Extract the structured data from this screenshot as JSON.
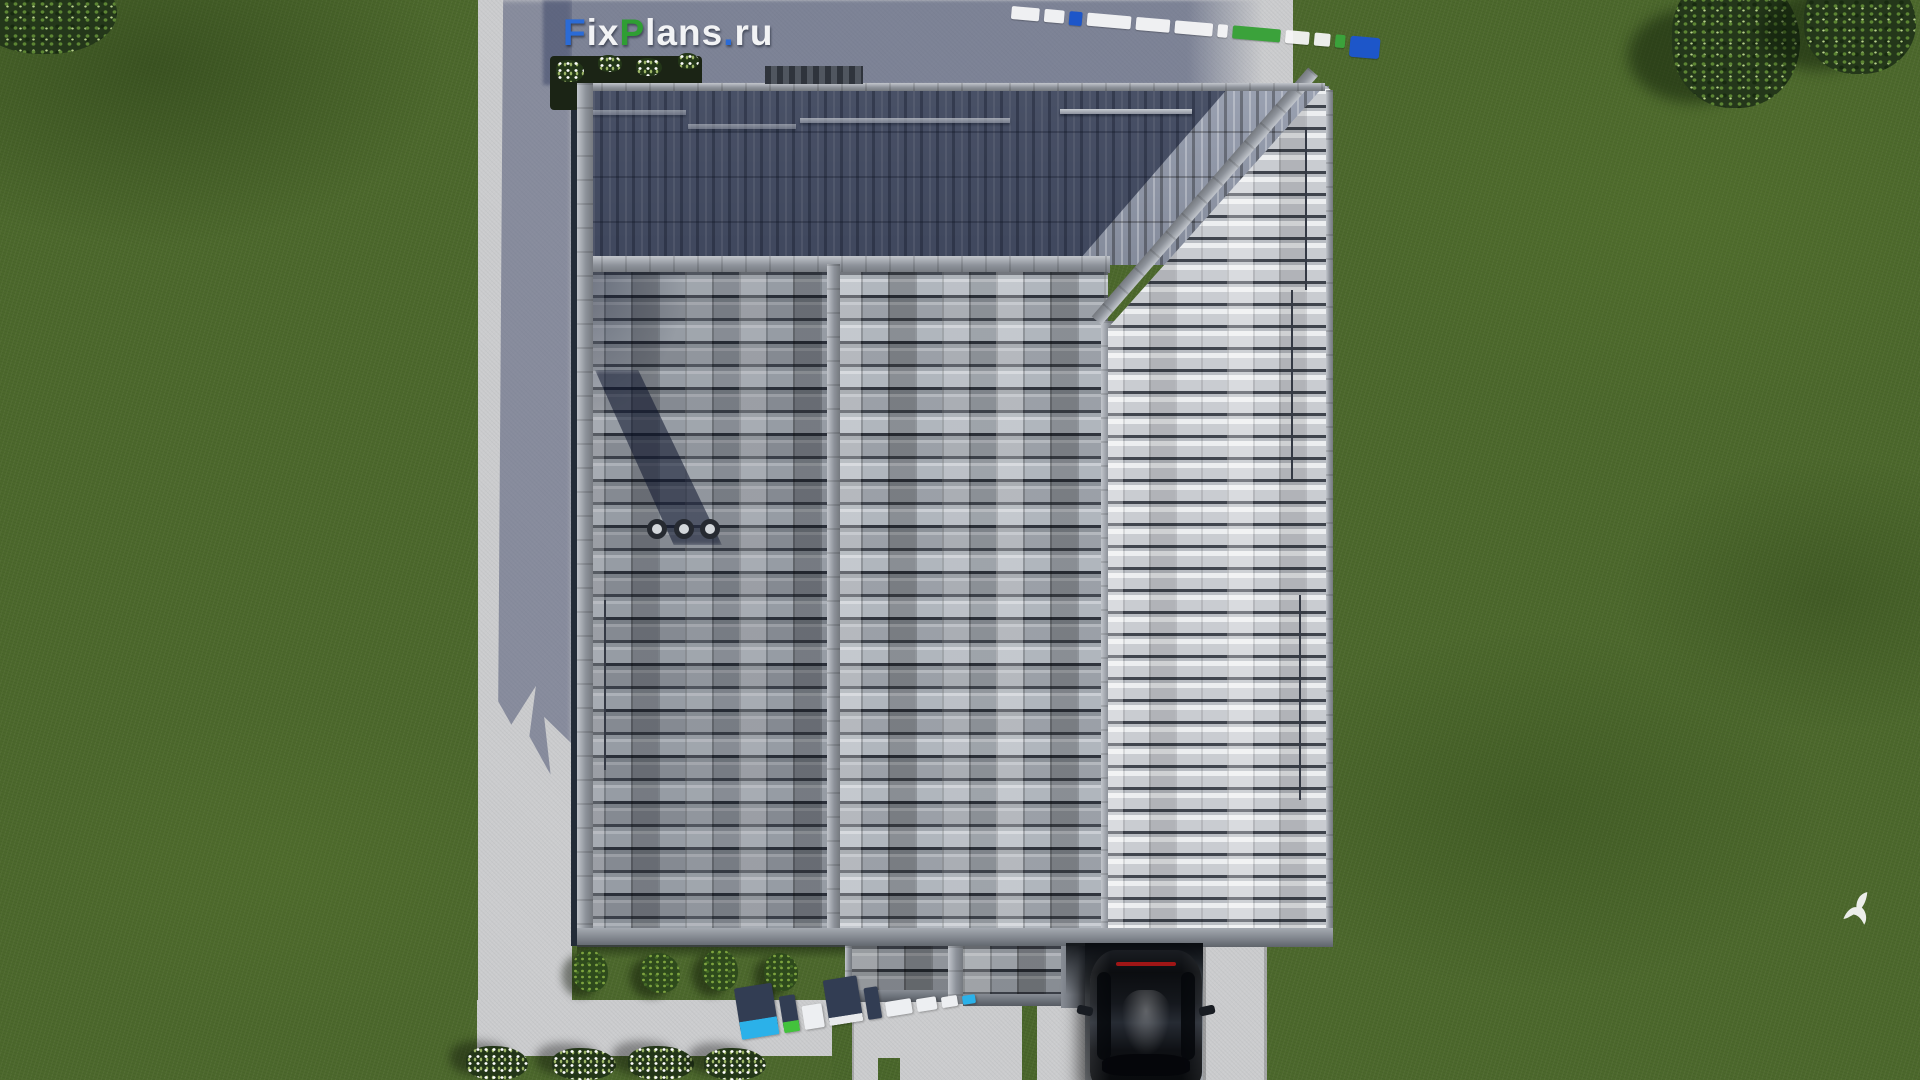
{
  "meta": {
    "description": "Aerial top-down 3D architectural render of a hip-roofed house with concrete tile roof, surrounding lawn, paved paths, driveway with black car, and FixPlans.ru watermarks",
    "scene_width": 1920,
    "scene_height": 1080
  },
  "branding": {
    "logo": {
      "text": "FixPlans.ru",
      "segments": [
        {
          "text": "F"
        },
        {
          "text": "ix"
        },
        {
          "text": "P"
        },
        {
          "text": "lans"
        },
        {
          "text": "."
        },
        {
          "text": "ru"
        }
      ]
    },
    "watermark_top_right": {
      "label": "FixPlans.ru 3D watermark seen from directly above"
    },
    "watermark_bottom": {
      "label": "FixPlans.ru 3D watermark standing on walkway"
    }
  },
  "scene_objects": {
    "roof": "hip roof with gray concrete tiles, ridge caps and chimney vents",
    "car": "black car parked on driveway, viewed from above",
    "lawn": "green lawn surrounding the plot",
    "paths": "light concrete paths and pads around the house",
    "bird": "white bird flying over the lawn",
    "vegetation": "trees, shrubs and white-flowering bushes"
  },
  "palette": {
    "brand_blue": "#2b6bd6",
    "brand_green": "#2f9e33",
    "logo_white": "#f2f3f5",
    "lawn_green": "#4c682c",
    "concrete_light": "#cbccce",
    "shadow_navy": "#3e4869",
    "roof_tile_gray": "#9aa0a8",
    "car_black": "#0b0d10",
    "watermark_cyan": "#2bb1e9",
    "watermark_green": "#43c23c",
    "taillight_red": "#a01616"
  }
}
